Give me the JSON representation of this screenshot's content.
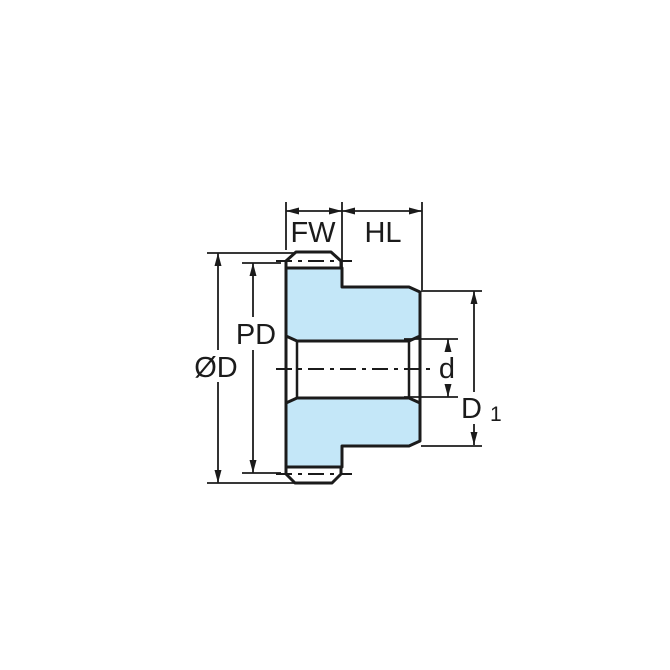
{
  "diagram": {
    "subject": "spur gear side cross-section technical drawing",
    "colors": {
      "background": "#ffffff",
      "part_fill": "#c4e7f8",
      "line": "#1b1b1b"
    },
    "dimensions": {
      "face_width": {
        "label": "FW"
      },
      "hub_length": {
        "label": "HL"
      },
      "pitch_diameter": {
        "label": "PD"
      },
      "outside_diameter": {
        "label": "ØD"
      },
      "bore_diameter": {
        "label": "d"
      },
      "hub_diameter": {
        "label": "D",
        "sub": "1"
      }
    }
  }
}
